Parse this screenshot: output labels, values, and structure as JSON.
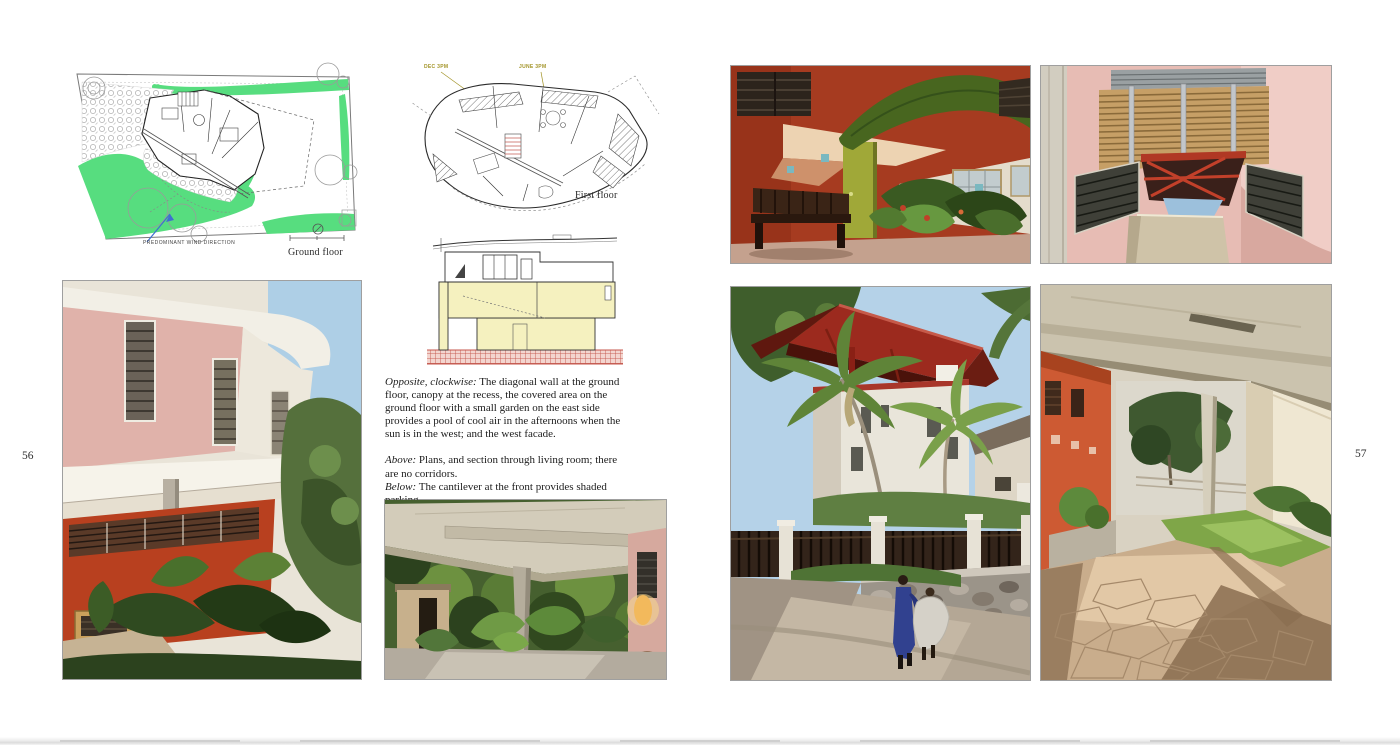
{
  "page_left": {
    "page_number": "56",
    "ground_floor_plan": {
      "wind_label": "PREDOMINANT WIND DIRECTION",
      "caption": "Ground floor"
    },
    "first_floor_plan": {
      "sun_label_dec": "DEC 3PM",
      "sun_label_june": "JUNE 3PM",
      "caption": "First floor"
    },
    "captions": {
      "para1_lead": "Opposite, clockwise:",
      "para1_text": " The diagonal wall at the ground floor, canopy at the recess, the covered area on the ground floor with a small garden on the east side provides a pool of cool air in the afternoons when the sun is in the west; and the west facade.",
      "para2_lead": "Above:",
      "para2_text": " Plans, and section through living room; there are no corridors.",
      "para3_lead": "Below:",
      "para3_text": " The cantilever at the front provides shaded parking.",
      "para4_lead": "Left:",
      "para4_text": " The recess at the first floor between the bedroom and the study allows through ventilation to both rooms."
    }
  },
  "page_right": {
    "page_number": "57"
  },
  "colors": {
    "landscape_green": "#57dd7f",
    "section_yellow": "#f5f1bf",
    "section_ground_red": "#c4574d",
    "section_ground_pink": "#f3d5cf",
    "sun_label_olive": "#a39428",
    "wind_arrow_blue": "#3f6fd0",
    "facade_red": "#b8401f",
    "canopy_red": "#9c2a1e",
    "wall_pink": "#e7bcb4"
  }
}
